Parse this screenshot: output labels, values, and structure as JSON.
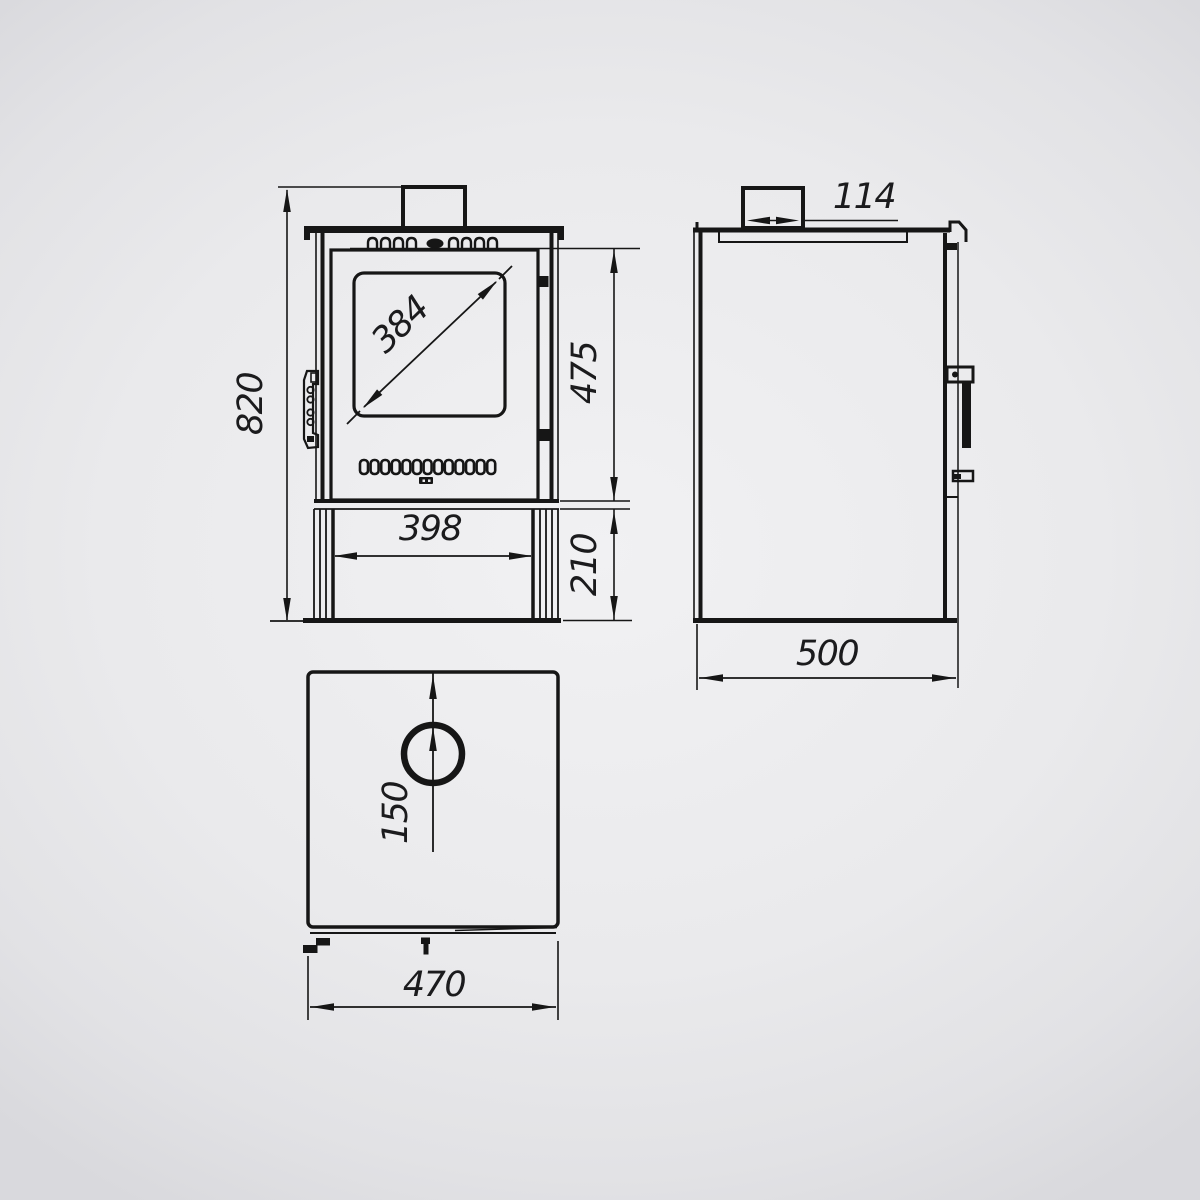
{
  "page": {
    "background": "#eaeaec",
    "line_color": "#161616",
    "text_color": "#1b1b1d"
  },
  "drawing": {
    "kind": "technical-dimension-drawing",
    "subject": "wood burning stove - three orthographic views",
    "dimensions": {
      "overall_height": "820",
      "glass_diagonal": "384",
      "firebox_section_height": "475",
      "base_inner_width": "398",
      "base_height": "210",
      "flue_collar_width": "114",
      "body_depth": "500",
      "flue_center_offset": "150",
      "body_width": "470"
    }
  }
}
